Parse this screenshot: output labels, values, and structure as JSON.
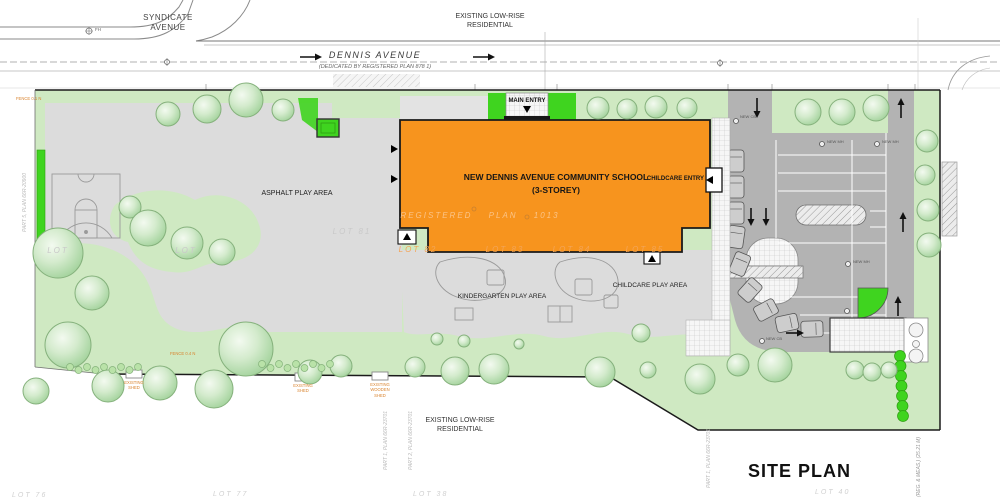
{
  "colors": {
    "building": "#F7941E",
    "lawn": "#CFE9C2",
    "vivid": "#3FD41F",
    "asphalt": "#DCDCDC",
    "parking": "#B3B3B3",
    "annotation": "#D9832E"
  },
  "streets": {
    "syndicate": "SYNDICATE\nAVENUE",
    "dennis_name": "DENNIS  AVENUE",
    "dennis_dedication": "(DEDICATED BY REGISTERED PLAN 878 1)",
    "hydrant_label": "FH"
  },
  "context": {
    "north_residential": "EXISTING LOW-RISE\nRESIDENTIAL",
    "south_residential": "EXISTING LOW-RISE\nRESIDENTIAL"
  },
  "building": {
    "name": "NEW DENNIS AVENUE COMMUNITY SCHOOL\n(3-STOREY)",
    "main_entry_label": "MAIN ENTRY",
    "childcare_entry_label": "CHILDCARE ENTRY",
    "plan_watermark": "REGISTERED PLAN 1013"
  },
  "play_areas": {
    "asphalt": "ASPHALT PLAY AREA",
    "kindergarten": "KINDERGARTEN PLAY AREA",
    "childcare": "CHILDCARE PLAY AREA"
  },
  "parking_labels": {
    "new_mh": "NEW MH",
    "new_cb": "NEW CB"
  },
  "lot_watermarks": {
    "lot_blank_1": "LOT",
    "lot_blank_2": "LOT",
    "lot81": "LOT 81",
    "lot82": "LOT 82",
    "lot83": "LOT 83",
    "lot84": "LOT 84",
    "lot85": "LOT 85",
    "lot76": "LOT 76",
    "lot77": "LOT 77",
    "lot38": "LOT 38",
    "lot40": "LOT 40"
  },
  "survey_notes": {
    "part5": "PART 5, PLAN 66R-20900",
    "part1": "PART 1, PLAN 66R-23701",
    "part2": "PART 2, PLAN 66R-23701",
    "part1b": "PART 1, PLAN 66R-23701",
    "reg_meas": "(REG. & MEAS.)  (25.21 M)"
  },
  "site_annotations": {
    "shed1": "EXISTING\nSHED",
    "shed2": "EXISTING\nWOODEN\nSHED",
    "shed3": "EXISTING\nSHED",
    "fence1": "FENCE 0.1 N",
    "fence2": "FENCE 0.4 N"
  },
  "title_block": {
    "drawing_title": "SITE PLAN"
  }
}
